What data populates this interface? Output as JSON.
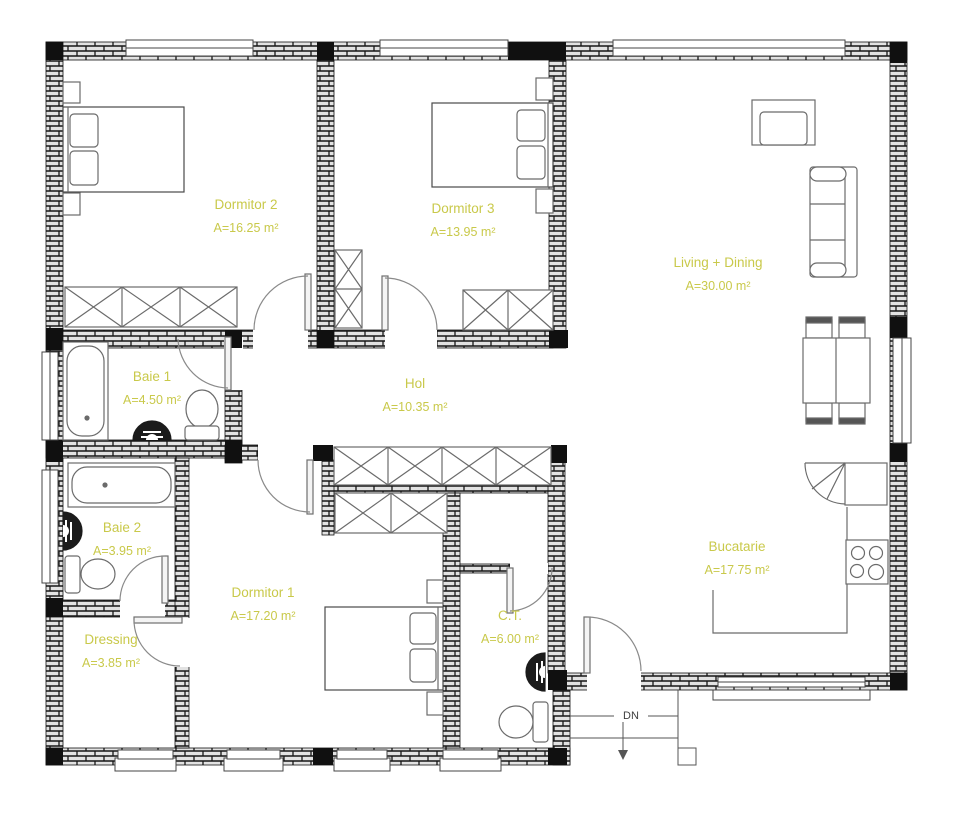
{
  "colors": {
    "label": "#c9c94a",
    "dn": "#3f3f3f"
  },
  "rooms": [
    {
      "id": "dormitor-2",
      "name": "Dormitor 2",
      "area": "A=16.25 m²"
    },
    {
      "id": "dormitor-3",
      "name": "Dormitor 3",
      "area": "A=13.95 m²"
    },
    {
      "id": "living-dining",
      "name": "Living + Dining",
      "area": "A=30.00 m²"
    },
    {
      "id": "baie-1",
      "name": "Baie 1",
      "area": "A=4.50 m²"
    },
    {
      "id": "hol",
      "name": "Hol",
      "area": "A=10.35 m²"
    },
    {
      "id": "baie-2",
      "name": "Baie 2",
      "area": "A=3.95 m²"
    },
    {
      "id": "dormitor-1",
      "name": "Dormitor 1",
      "area": "A=17.20 m²"
    },
    {
      "id": "dressing",
      "name": "Dressing",
      "area": "A=3.85 m²"
    },
    {
      "id": "ct",
      "name": "C.T.",
      "area": "A=6.00 m²"
    },
    {
      "id": "bucatarie",
      "name": "Bucatarie",
      "area": "A=17.75 m²"
    }
  ],
  "annotations": {
    "stairs_label": "DN"
  }
}
